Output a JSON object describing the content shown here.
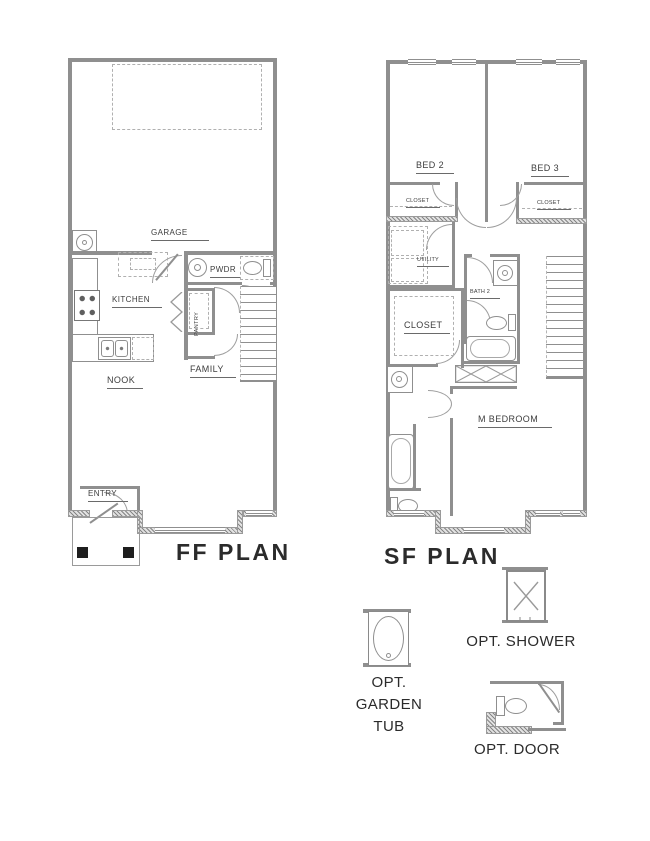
{
  "ff_plan": {
    "title": "FF PLAN",
    "rooms": {
      "garage": "GARAGE",
      "kitchen": "KITCHEN",
      "pwdr": "PWDR",
      "pantry": "PANTRY",
      "family": "FAMILY",
      "nook": "NOOK",
      "entry": "ENTRY"
    }
  },
  "sf_plan": {
    "title": "SF PLAN",
    "rooms": {
      "bed2": "BED 2",
      "bed3": "BED 3",
      "closet_bed2": "CLOSET",
      "closet_bed3": "CLOSET",
      "utility": "UTILITY",
      "bath2": "BATH 2",
      "walkin_closet": "CLOSET",
      "m_bedroom": "M BEDROOM"
    }
  },
  "options": {
    "shower": "OPT. SHOWER",
    "garden_tub": {
      "line1": "OPT.",
      "line2": "GARDEN",
      "line3": "TUB"
    },
    "door": "OPT. DOOR"
  },
  "colors": {
    "wall": "#8f8f8f",
    "text": "#3d3d3d",
    "title": "#2b2b2b",
    "background": "#ffffff"
  }
}
